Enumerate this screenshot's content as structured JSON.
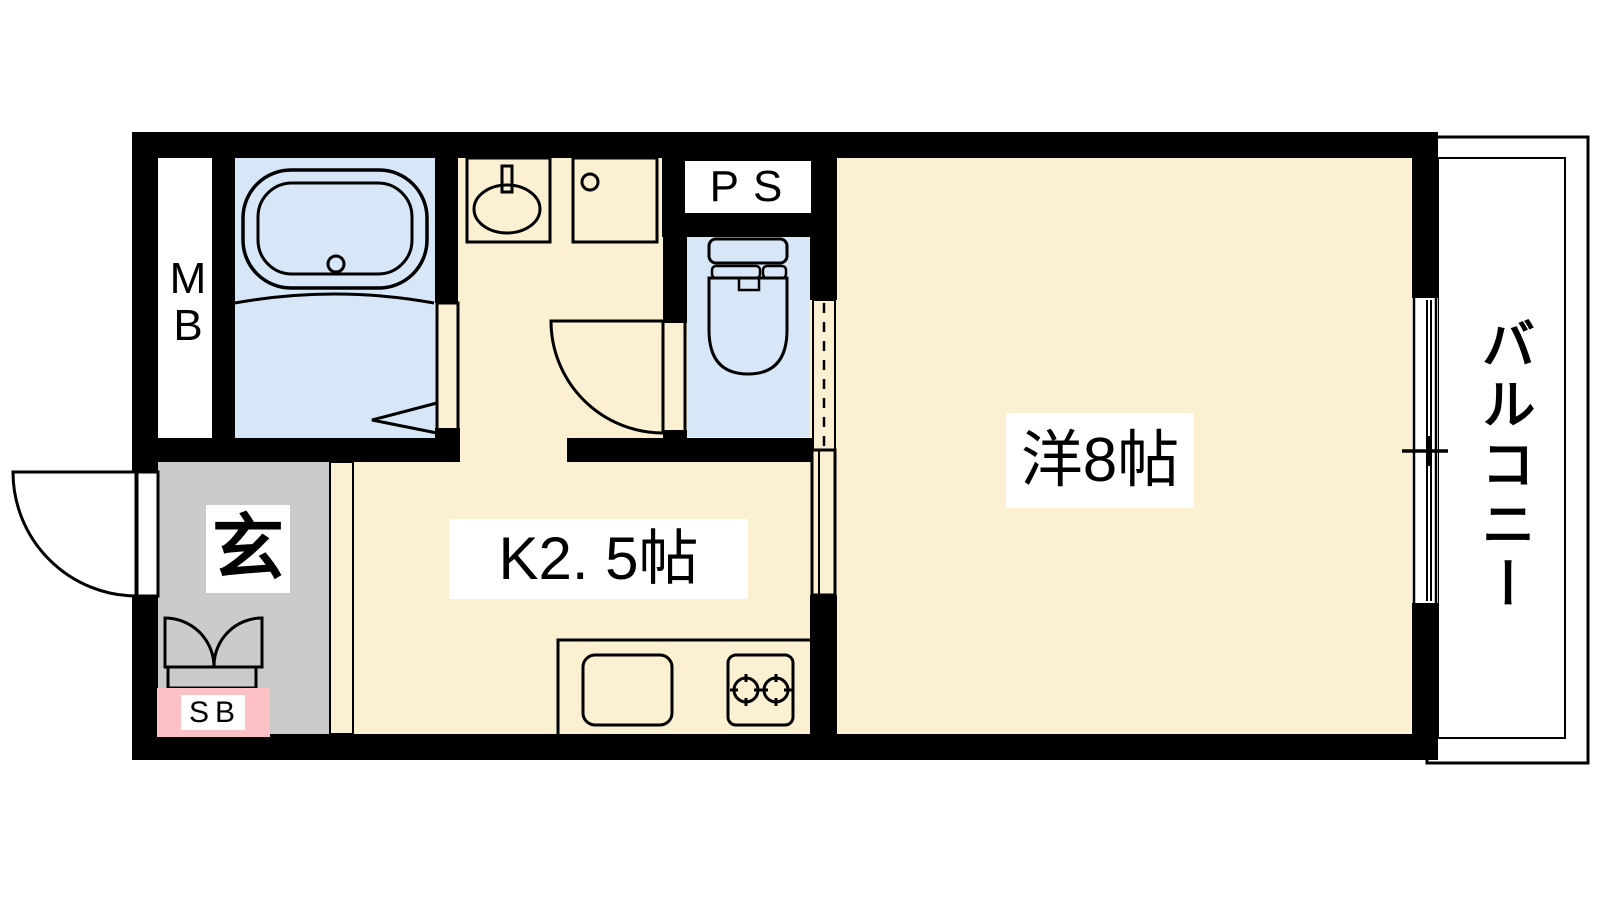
{
  "plan": {
    "type": "apartment-floor-plan",
    "labels": {
      "mb": "MB",
      "ps": "PS",
      "entrance": "玄",
      "shoe_box": "SB",
      "kitchen": "K2. 5帖",
      "western_room": "洋8帖",
      "balcony": "バルコニー"
    },
    "rooms": [
      {
        "name": "kitchen",
        "label": "K2. 5帖",
        "floor": "beige"
      },
      {
        "name": "western-room",
        "label": "洋8帖",
        "floor": "beige"
      },
      {
        "name": "entrance-genkan",
        "label": "玄",
        "floor": "gray"
      },
      {
        "name": "bathroom",
        "label": "",
        "floor": "blue"
      },
      {
        "name": "toilet",
        "label": "",
        "floor": "blue"
      },
      {
        "name": "balcony",
        "label": "バルコニー",
        "floor": "gray"
      },
      {
        "name": "meter-box",
        "label": "MB",
        "floor": "white"
      },
      {
        "name": "pipe-space",
        "label": "PS",
        "floor": "black"
      },
      {
        "name": "shoe-box",
        "label": "SB",
        "floor": "pink"
      }
    ],
    "colors": {
      "wall": "#000000",
      "floor": "#FCF0D2",
      "sanitary": "#D8E7F7",
      "entrance_floor": "#CBCBCB",
      "balcony_floor": "#D2D2D2",
      "shoe_box": "#FBC1C5",
      "kitchen_counter": "#EADFF3"
    }
  }
}
